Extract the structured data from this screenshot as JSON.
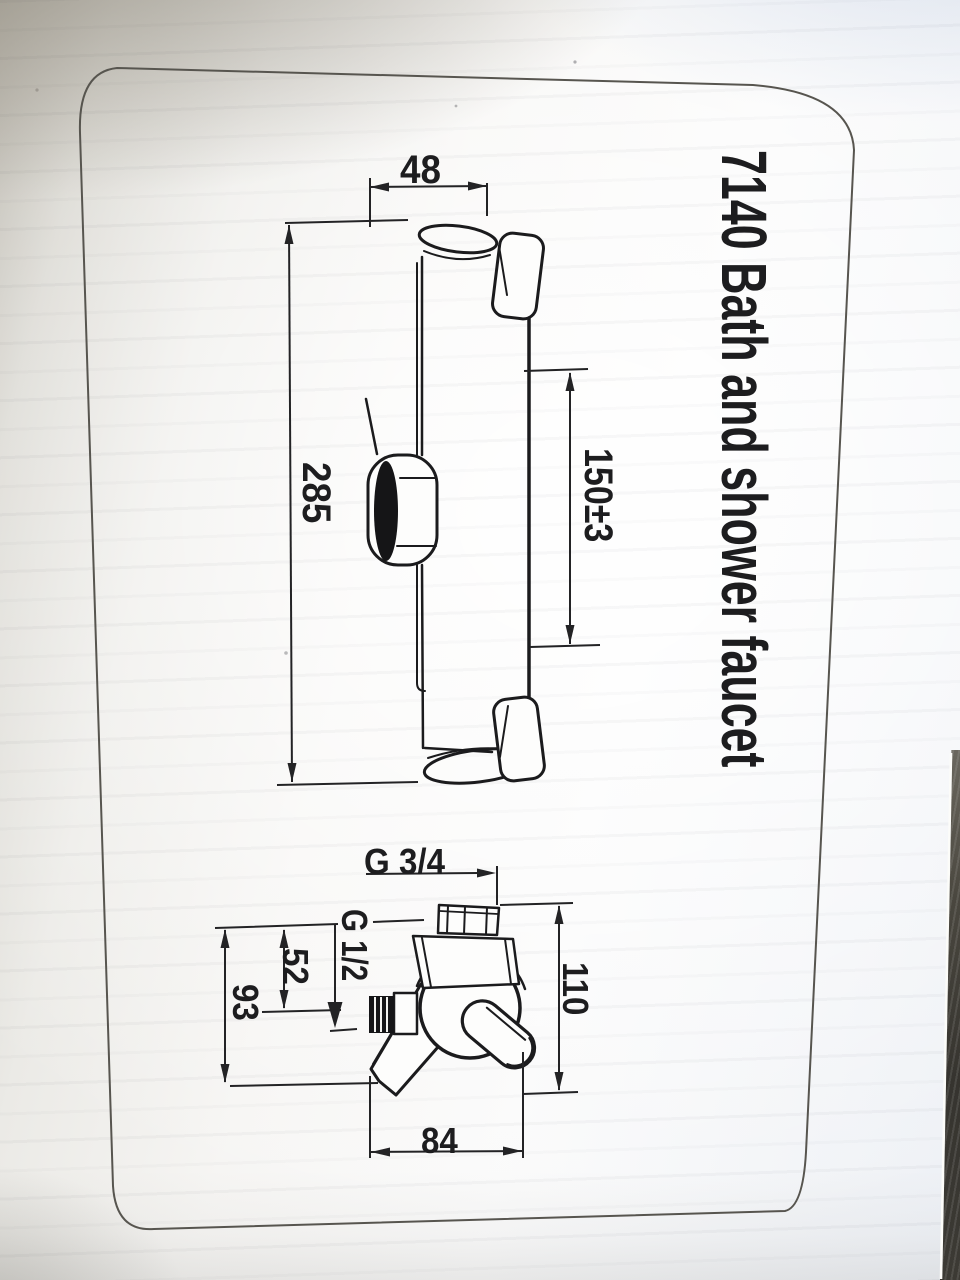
{
  "photo": {
    "title": "7140 Bath and shower faucet"
  },
  "slide_bar": {
    "width": "48",
    "length": "285",
    "travel": "150±3"
  },
  "valve": {
    "top_thread": "G 3/4",
    "outlet_thread": "G 1/2",
    "outlet_offset": "52",
    "bracket_offset": "93",
    "height": "110",
    "width": "84"
  },
  "colors": {
    "ink": "#1b1b1d",
    "border_line": "#57554f",
    "paper_shadow_warm": "#a7a399",
    "paper_highlight": "#fafafa",
    "paper_cool": "#e9edf3",
    "table_dark": "#3a3833"
  }
}
